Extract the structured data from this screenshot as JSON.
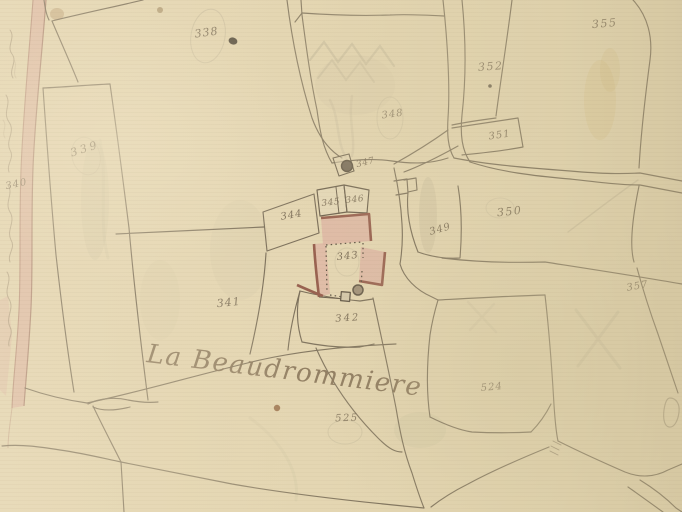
{
  "map": {
    "type": "cadastral-map-scan",
    "toponym": "La Beaudrommiere",
    "parcels": [
      {
        "label": "338",
        "x": 207,
        "y": 36,
        "rot": -8,
        "fs": 11,
        "ls": 1
      },
      {
        "label": "339",
        "x": 86,
        "y": 152,
        "rot": -18,
        "fs": 11,
        "ls": 3
      },
      {
        "label": "340",
        "x": 17,
        "y": 187,
        "rot": -12,
        "fs": 10,
        "ls": 1
      },
      {
        "label": "341",
        "x": 229,
        "y": 306,
        "rot": -6,
        "fs": 11,
        "ls": 1
      },
      {
        "label": "342",
        "x": 348,
        "y": 321,
        "rot": -4,
        "fs": 10,
        "ls": 2
      },
      {
        "label": "343",
        "x": 348,
        "y": 259,
        "rot": -6,
        "fs": 10,
        "ls": 1
      },
      {
        "label": "344",
        "x": 292,
        "y": 218,
        "rot": -10,
        "fs": 10,
        "ls": 1
      },
      {
        "label": "345",
        "x": 331,
        "y": 205,
        "rot": -6,
        "fs": 9,
        "ls": 0.5
      },
      {
        "label": "346",
        "x": 355,
        "y": 202,
        "rot": -6,
        "fs": 9,
        "ls": 0.5
      },
      {
        "label": "347",
        "x": 366,
        "y": 165,
        "rot": -14,
        "fs": 9,
        "ls": 0.5
      },
      {
        "label": "348",
        "x": 393,
        "y": 117,
        "rot": -8,
        "fs": 10,
        "ls": 1
      },
      {
        "label": "349",
        "x": 441,
        "y": 232,
        "rot": -16,
        "fs": 10,
        "ls": 1
      },
      {
        "label": "350",
        "x": 510,
        "y": 215,
        "rot": -6,
        "fs": 11,
        "ls": 1.5
      },
      {
        "label": "351",
        "x": 500,
        "y": 138,
        "rot": -8,
        "fs": 10,
        "ls": 1
      },
      {
        "label": "352",
        "x": 491,
        "y": 70,
        "rot": -4,
        "fs": 11,
        "ls": 1.5
      },
      {
        "label": "355",
        "x": 605,
        "y": 27,
        "rot": -5,
        "fs": 11,
        "ls": 1.5
      },
      {
        "label": "357",
        "x": 638,
        "y": 289,
        "rot": -10,
        "fs": 10,
        "ls": 1
      },
      {
        "label": "524",
        "x": 492,
        "y": 390,
        "rot": -5,
        "fs": 10,
        "ls": 1
      },
      {
        "label": "525",
        "x": 347,
        "y": 421,
        "rot": -2,
        "fs": 10,
        "ls": 1.5
      }
    ],
    "colors": {
      "paper": "#e4d6b2",
      "ink_line": "#44392c",
      "road_band": "#d8a29a",
      "building_fill": "#dcab9f",
      "building_outline": "#7e392e",
      "label_ink": "#4a3c2c",
      "toponym_ink": "#5c462f",
      "pencil": "#8d8672"
    }
  }
}
